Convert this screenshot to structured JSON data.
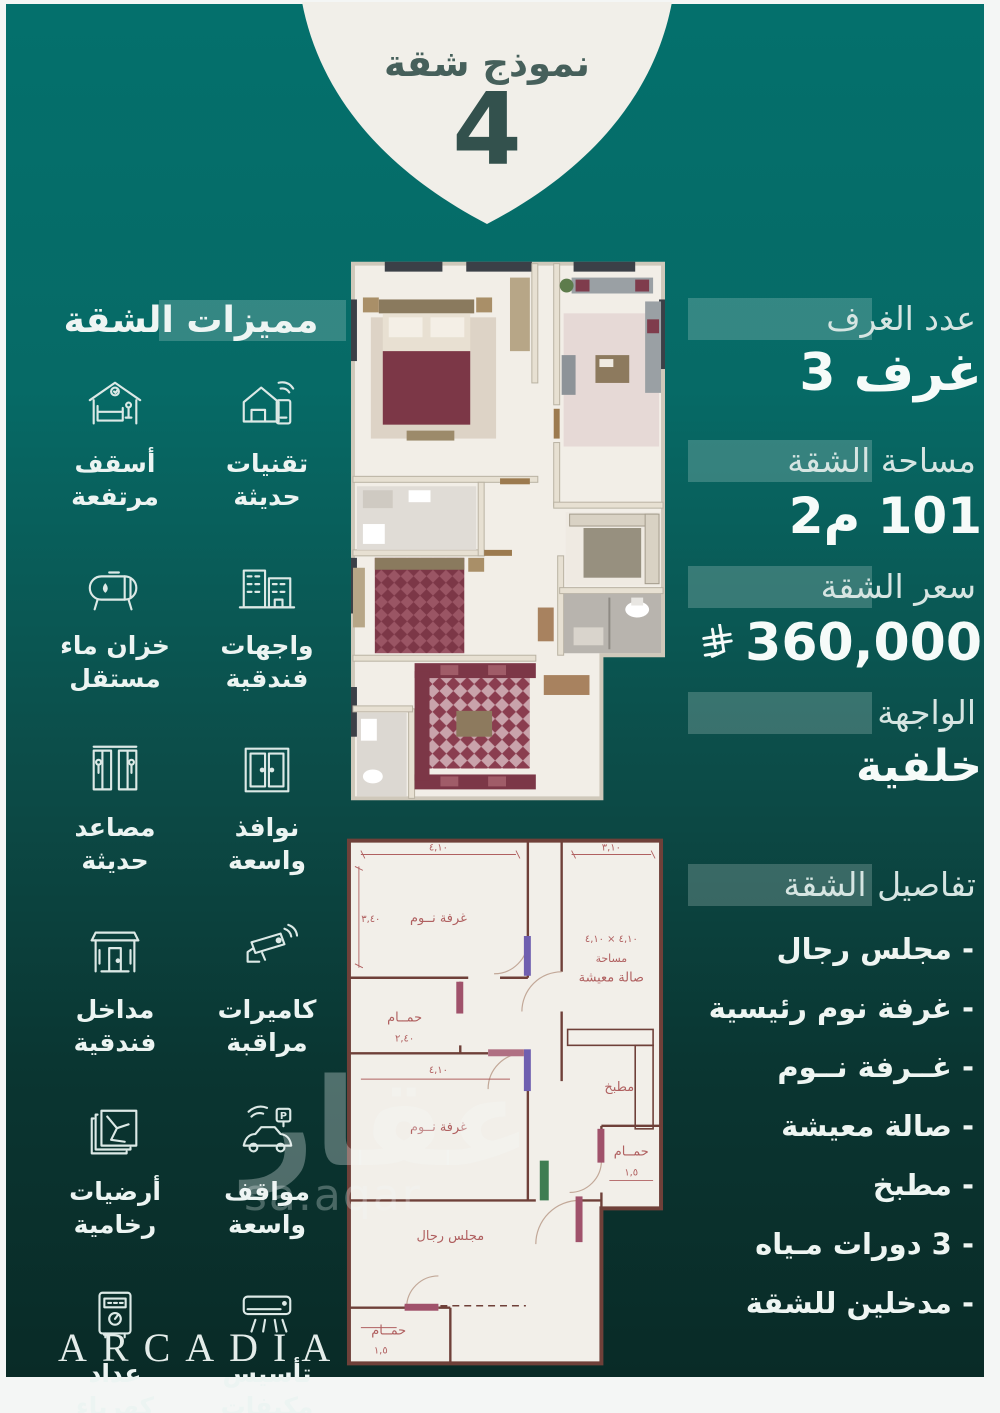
{
  "badge": {
    "title": "نموذج شقة",
    "number": "4"
  },
  "features": {
    "header": "مميزات الشقة",
    "items": [
      {
        "icon": "smart-home-icon",
        "label": "تقنيات حديثة"
      },
      {
        "icon": "high-ceilings-icon",
        "label": "أسقف مرتفعة"
      },
      {
        "icon": "hotel-facades-icon",
        "label": "واجهات فندقية"
      },
      {
        "icon": "water-tank-icon",
        "label": "خزان ماء مستقل"
      },
      {
        "icon": "wide-windows-icon",
        "label": "نوافذ واسعة"
      },
      {
        "icon": "elevators-icon",
        "label": "مصاعد حديثة"
      },
      {
        "icon": "cctv-icon",
        "label": "كاميرات مراقبة"
      },
      {
        "icon": "hotel-entrances-icon",
        "label": "مداخل فندقية"
      },
      {
        "icon": "parking-icon",
        "label": "مواقف واسعة"
      },
      {
        "icon": "marble-floors-icon",
        "label": "أرضيات رخامية"
      },
      {
        "icon": "split-ac-icon",
        "label": "تأسيس مكيفات سبلت"
      },
      {
        "icon": "electric-meter-icon",
        "label": "عداد كهرباء مستقل"
      }
    ],
    "parking_letter": "P"
  },
  "details": {
    "rooms_label": "عدد الغرف",
    "rooms_value": "3 غرف",
    "area_label": "مساحة الشقة",
    "area_value": "101 م2",
    "price_label": "سعر الشقة",
    "price_value": "360,000",
    "currency_icon": "saudi-riyal-symbol",
    "facade_label": "الواجهة",
    "facade_value": "خلفية",
    "list_header": "تفاصيل الشقة",
    "list_items": [
      "- مجلس رجال",
      "- غرفة نوم رئيسية",
      "- غــرفة نــوم",
      "- صالة معيشة",
      "- مطبخ",
      "- 3 دورات مـياه",
      "- مدخلين للشقة"
    ]
  },
  "plan2d_labels": {
    "bedroom_top": "غرفة نــوم",
    "living_dims": "٤,١٠ × ٤,١٠",
    "living_word": "مساحة",
    "living": "صالة معيشة",
    "bath_mid": "حمــام",
    "bath_mid_dim": "٢,٤٠",
    "bedroom_bottom": "غرفة نــوم",
    "kitchen": "مطبخ",
    "majlis": "مجلس رجال",
    "bath_bottom": "حمــام",
    "bath_bottom_dim": "١,٥",
    "bath_right": "حمــام",
    "bath_right_dim": "١,٥",
    "dim_top_left": "٤,١٠",
    "dim_top_right": "٣,١٠",
    "dim_left": "٣,٤٠",
    "dim_bottom": "٤,١٠"
  },
  "watermark": {
    "arabic": "عقار",
    "latin": "sa.aqar"
  },
  "brand": {
    "name": "ARCADIA"
  },
  "colors": {
    "teal_top": "#04706c",
    "green_bottom": "#092b27",
    "badge_bg": "#f1efe9",
    "badge_text": "#33514d",
    "accent_maroon": "#7c3747",
    "plan_paper": "#f2efe9",
    "plan_line": "#6f4039",
    "icon_line": "#dce9e6"
  }
}
